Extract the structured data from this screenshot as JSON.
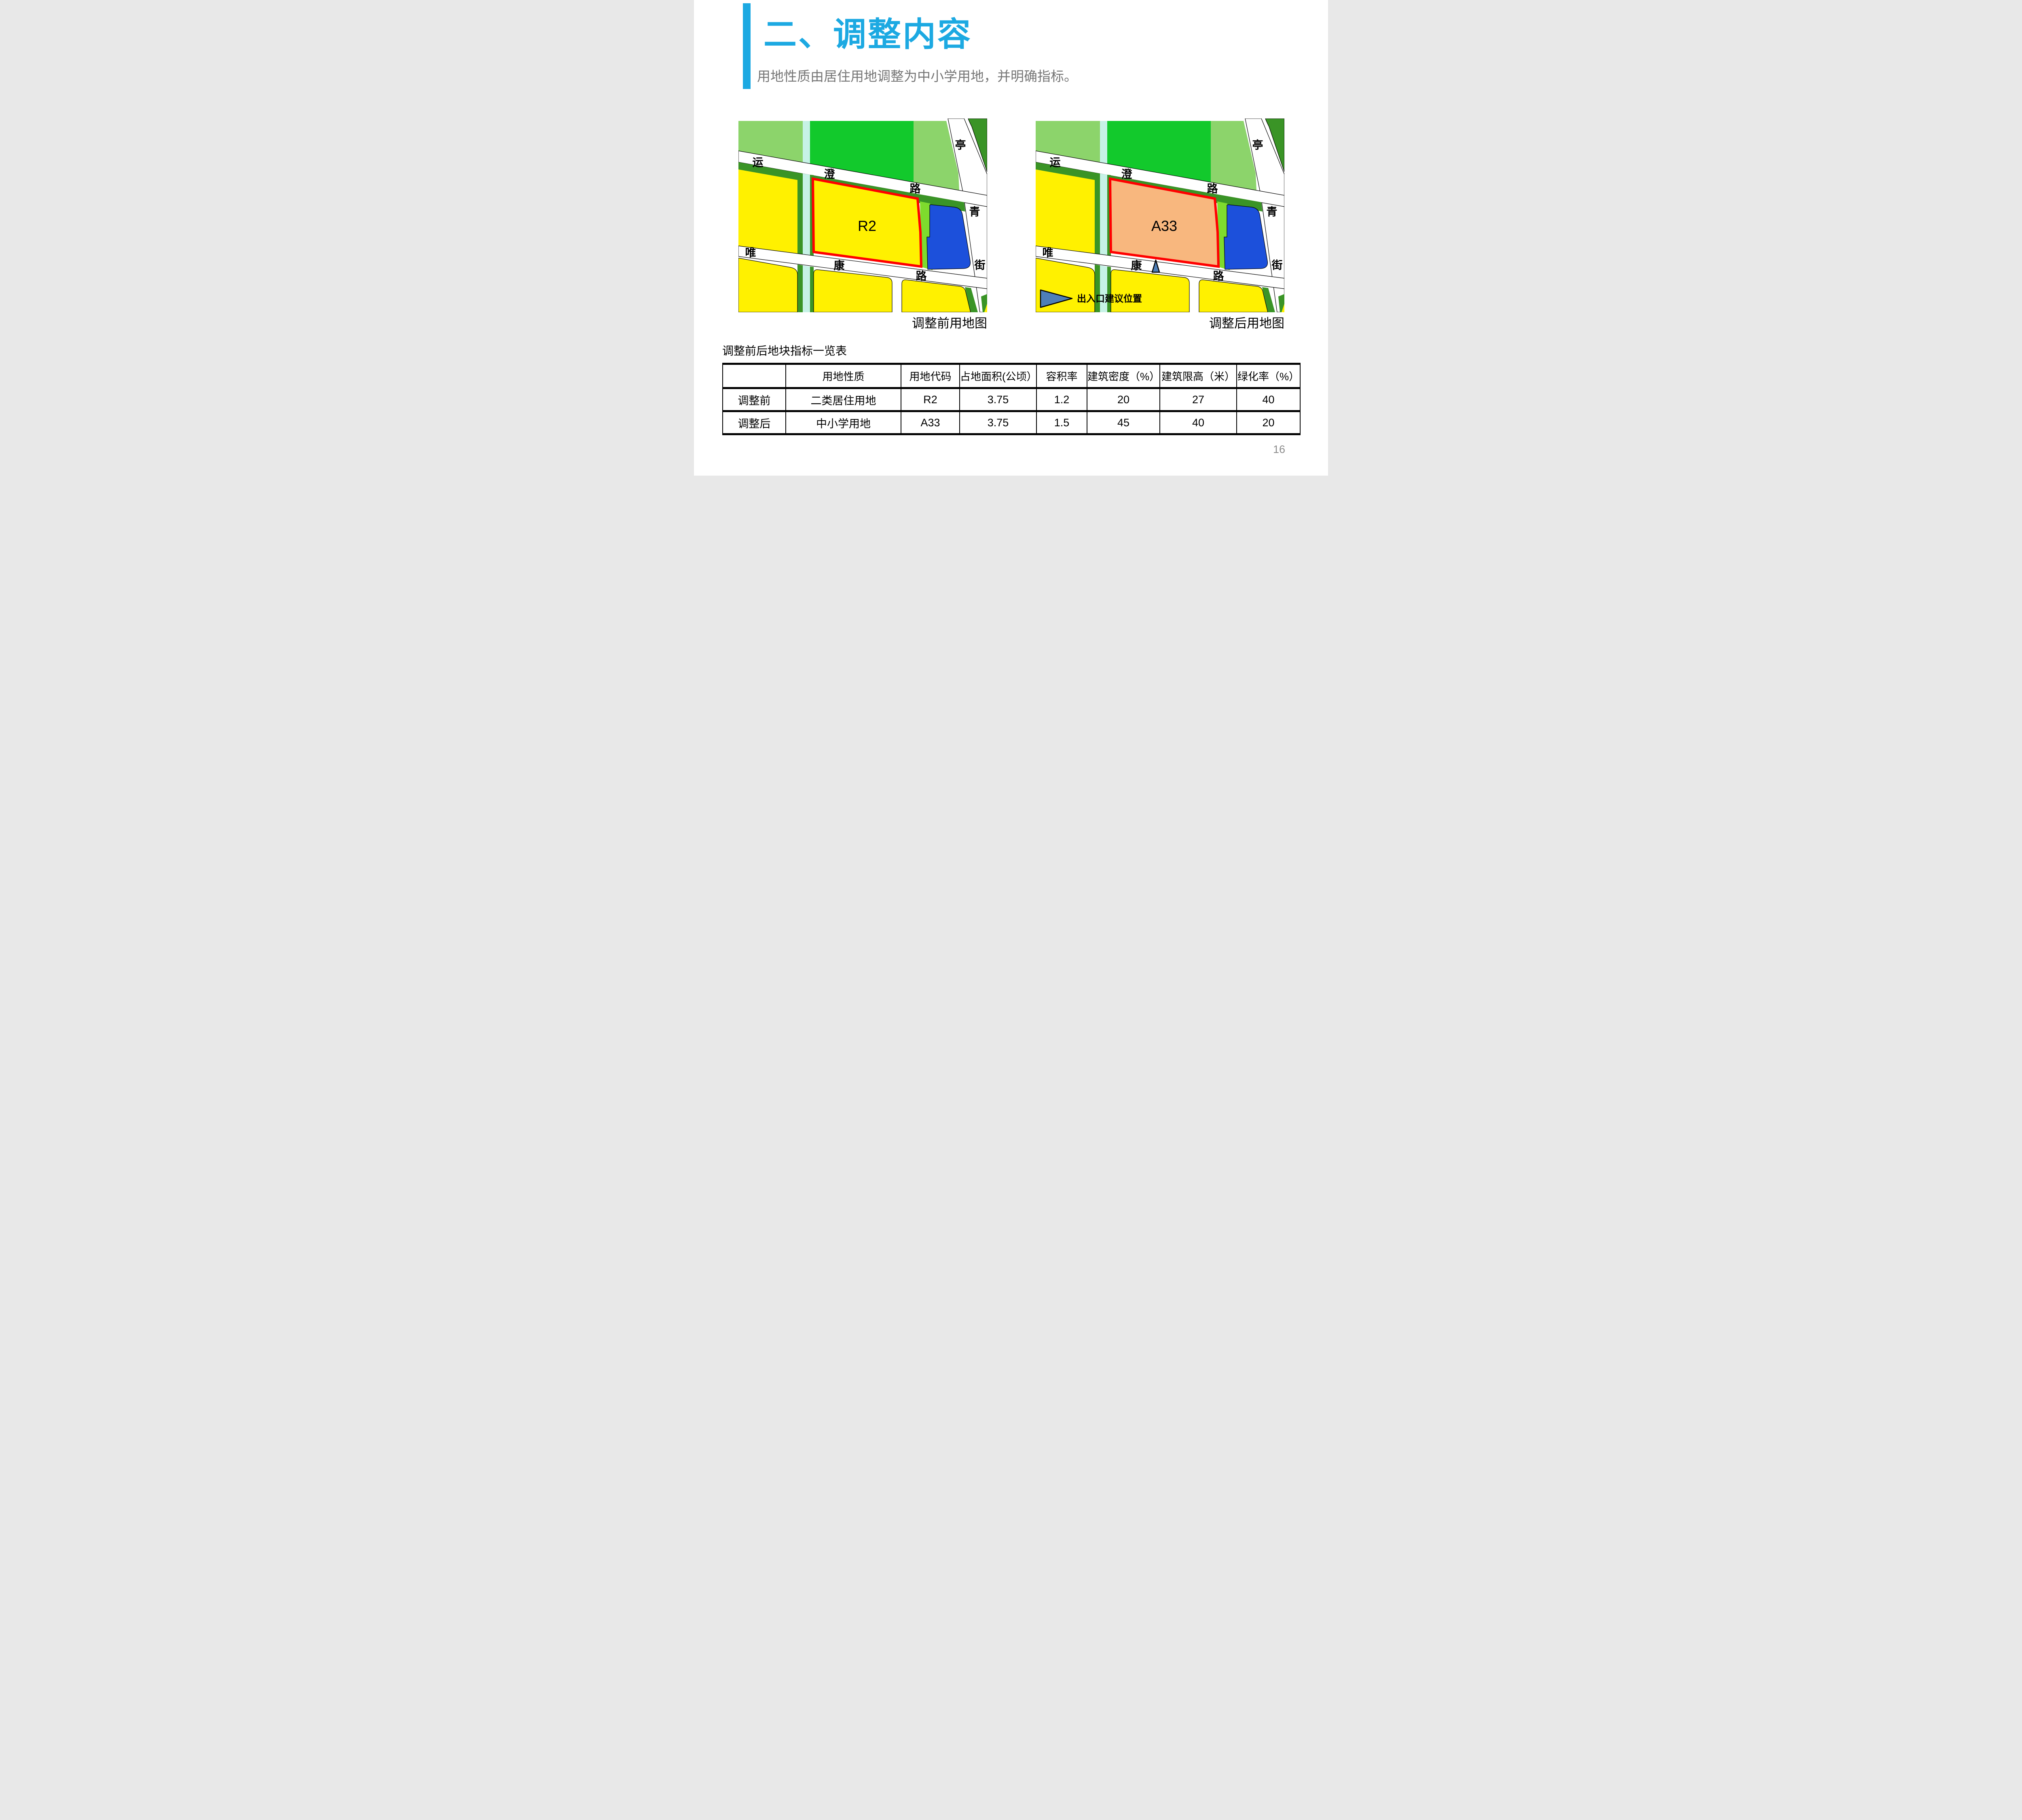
{
  "slide": {
    "title": "二、调整内容",
    "subtitle": "用地性质由居住用地调整为中小学用地，并明确指标。",
    "page_number": "16"
  },
  "maps": {
    "left": {
      "parcel_label": "R2",
      "caption": "调整前用地图"
    },
    "right": {
      "parcel_label": "A33",
      "caption": "调整后用地图",
      "legend_label": "出入口建议位置"
    },
    "road_labels": {
      "yun": "运",
      "cheng": "澄",
      "lu_top": "路",
      "ting": "亭",
      "qing": "青",
      "jie": "街",
      "wei": "唯",
      "kang": "康",
      "lu_bottom": "路"
    }
  },
  "table": {
    "title": "调整前后地块指标一览表",
    "headers": [
      "",
      "用地性质",
      "用地代码",
      "占地面积(公顷）",
      "容积率",
      "建筑密度（%）",
      "建筑限高（米）",
      "绿化率（%）"
    ],
    "rows": [
      {
        "label": "调整前",
        "values": [
          "二类居住用地",
          "R2",
          "3.75",
          "1.2",
          "20",
          "27",
          "40"
        ]
      },
      {
        "label": "调整后",
        "values": [
          "中小学用地",
          "A33",
          "3.75",
          "1.5",
          "45",
          "40",
          "20"
        ]
      }
    ]
  },
  "colors": {
    "accent_blue": "#1CA9E2",
    "subtitle_gray": "#767676",
    "highlight_red": "#FF0000",
    "parcel_yellow": "#FFF100",
    "parcel_orange": "#F8B77E",
    "parcel_blue": "#1C50DB",
    "park_green": "#12C92C",
    "light_green": "#8CD46B",
    "buffer_green": "#3A9426",
    "lime_green": "#7EDB2D",
    "canal_cyan": "#C6F2E6",
    "marker_blue": "#4E7FB8"
  }
}
